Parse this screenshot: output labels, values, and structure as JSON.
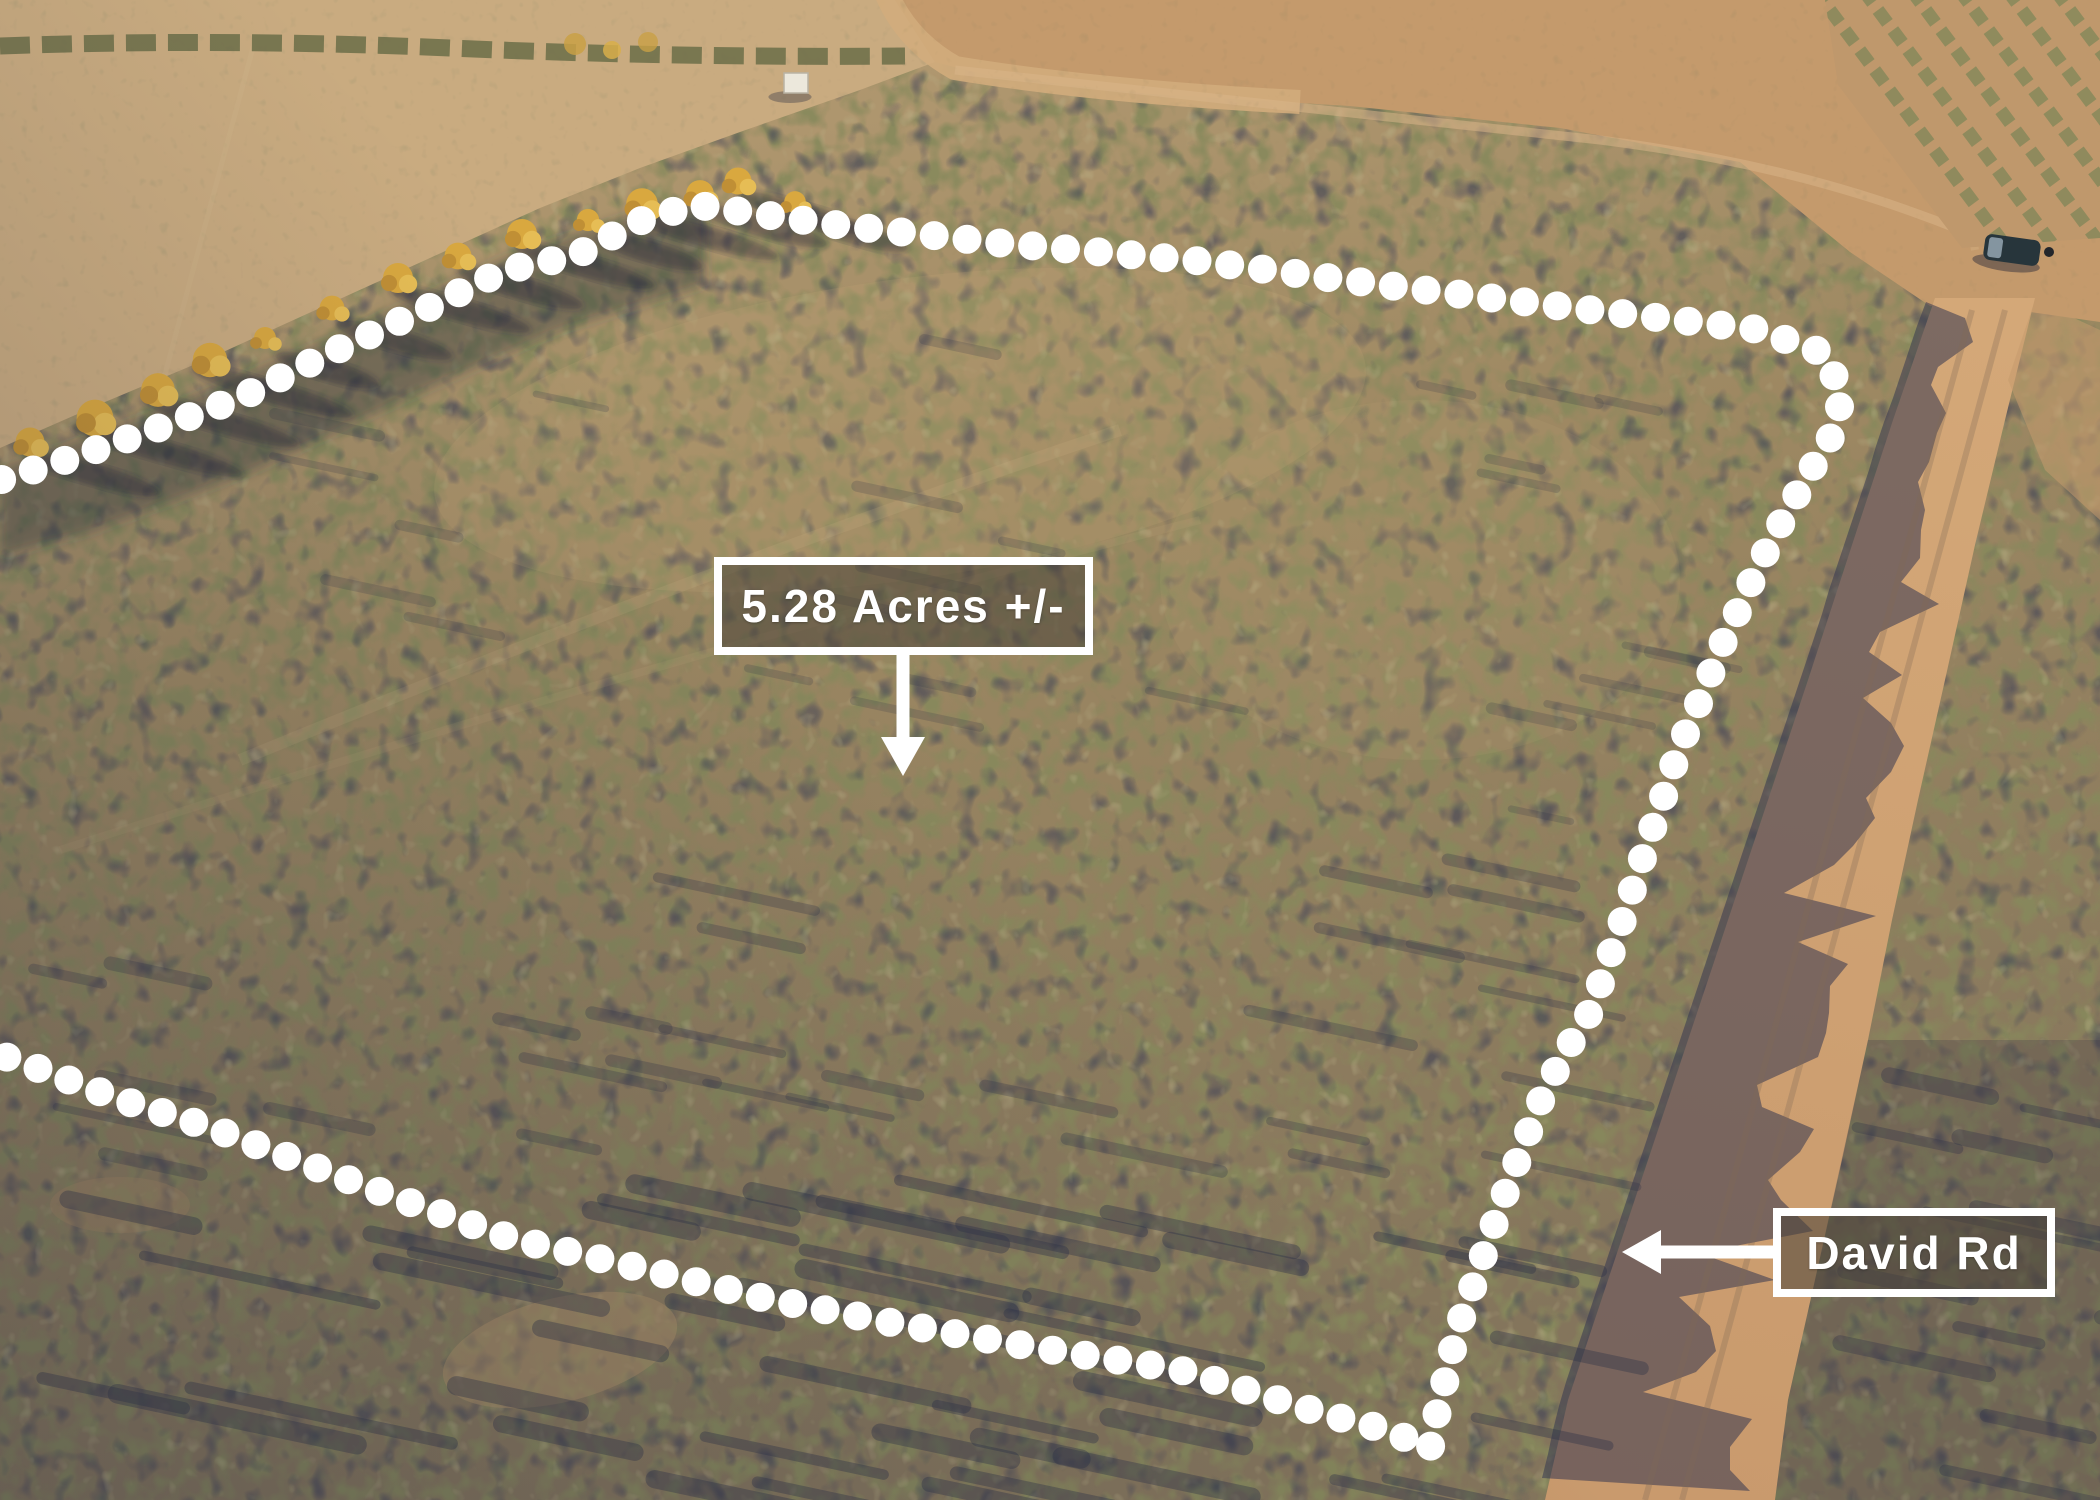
{
  "scene": {
    "description": "aerial-drone-photo-of-desert-land-parcel",
    "labels": {
      "acreage": {
        "text": "5.28 Acres +/-",
        "x": 714,
        "y": 557,
        "w": 379,
        "h": 98,
        "arrow": {
          "dir": "down",
          "tip": [
            903,
            776
          ],
          "base": [
            903,
            655
          ]
        }
      },
      "road": {
        "text": "David Rd",
        "x": 1773,
        "y": 1208,
        "w": 282,
        "h": 89,
        "arrow": {
          "dir": "left",
          "tip": [
            1622,
            1252
          ],
          "base": [
            1773,
            1252
          ]
        }
      }
    },
    "colors": {
      "boundary_dot": "#ffffff",
      "label_border": "#ffffff",
      "label_text": "#ffffff",
      "label_bg": "rgba(74,67,59,0.55)",
      "road_surface": "#cd9e70",
      "open_field": "#c9ab80",
      "scrub_green": "#87895c",
      "scrub_shadow": "#3f4257",
      "tree_gold": "#d9a83f",
      "vehicle_body": "#27353b"
    },
    "boundary": {
      "dot_radius": 14.5,
      "dot_spacing": 33,
      "points": [
        [
          -30,
          489
        ],
        [
          60,
          462
        ],
        [
          150,
          431
        ],
        [
          240,
          398
        ],
        [
          330,
          353
        ],
        [
          420,
          312
        ],
        [
          505,
          270
        ],
        [
          575,
          256
        ],
        [
          640,
          221
        ],
        [
          695,
          205
        ],
        [
          830,
          224
        ],
        [
          1000,
          243
        ],
        [
          1200,
          261
        ],
        [
          1400,
          287
        ],
        [
          1600,
          311
        ],
        [
          1755,
          329
        ],
        [
          1824,
          353
        ],
        [
          1842,
          394
        ],
        [
          1835,
          430
        ],
        [
          1815,
          463
        ],
        [
          1795,
          498
        ],
        [
          1776,
          532
        ],
        [
          1757,
          569
        ],
        [
          1739,
          609
        ],
        [
          1719,
          651
        ],
        [
          1705,
          689
        ],
        [
          1689,
          725
        ],
        [
          1675,
          761
        ],
        [
          1662,
          801
        ],
        [
          1647,
          844
        ],
        [
          1634,
          885
        ],
        [
          1620,
          928
        ],
        [
          1606,
          967
        ],
        [
          1592,
          1009
        ],
        [
          1564,
          1054
        ],
        [
          1541,
          1100
        ],
        [
          1523,
          1146
        ],
        [
          1506,
          1191
        ],
        [
          1490,
          1236
        ],
        [
          1473,
          1286
        ],
        [
          1457,
          1331
        ],
        [
          1445,
          1381
        ],
        [
          1434,
          1426
        ],
        [
          1430,
          1450
        ],
        [
          1391,
          1431
        ],
        [
          1321,
          1413
        ],
        [
          1249,
          1391
        ],
        [
          1177,
          1369
        ],
        [
          1051,
          1350
        ],
        [
          899,
          1324
        ],
        [
          759,
          1297
        ],
        [
          619,
          1263
        ],
        [
          513,
          1239
        ],
        [
          389,
          1195
        ],
        [
          299,
          1161
        ],
        [
          209,
          1127
        ],
        [
          119,
          1099
        ],
        [
          29,
          1065
        ],
        [
          -30,
          1044
        ]
      ]
    },
    "road": {
      "name": "David Rd",
      "left_edge": [
        [
          1935,
          298
        ],
        [
          1893,
          420
        ],
        [
          1852,
          545
        ],
        [
          1808,
          680
        ],
        [
          1768,
          800
        ],
        [
          1728,
          920
        ],
        [
          1688,
          1040
        ],
        [
          1648,
          1160
        ],
        [
          1608,
          1280
        ],
        [
          1568,
          1400
        ],
        [
          1545,
          1500
        ]
      ],
      "right_edge": [
        [
          2035,
          298
        ],
        [
          2005,
          420
        ],
        [
          1975,
          545
        ],
        [
          1945,
          680
        ],
        [
          1918,
          800
        ],
        [
          1892,
          920
        ],
        [
          1868,
          1040
        ],
        [
          1842,
          1160
        ],
        [
          1815,
          1280
        ],
        [
          1788,
          1400
        ],
        [
          1775,
          1500
        ]
      ]
    },
    "trees": [
      [
        30,
        442
      ],
      [
        95,
        418
      ],
      [
        158,
        390
      ],
      [
        210,
        360
      ],
      [
        265,
        338
      ],
      [
        332,
        308
      ],
      [
        398,
        278
      ],
      [
        458,
        256
      ],
      [
        522,
        234
      ],
      [
        588,
        220
      ],
      [
        642,
        204
      ],
      [
        700,
        194
      ],
      [
        738,
        181
      ],
      [
        795,
        202
      ]
    ],
    "vehicle": {
      "x": 2012,
      "y": 250,
      "w": 56,
      "h": 26,
      "angle": 8
    },
    "person": {
      "x": 2049,
      "y": 252,
      "r": 5
    },
    "shed": {
      "x": 784,
      "y": 73,
      "w": 24,
      "h": 20
    }
  }
}
